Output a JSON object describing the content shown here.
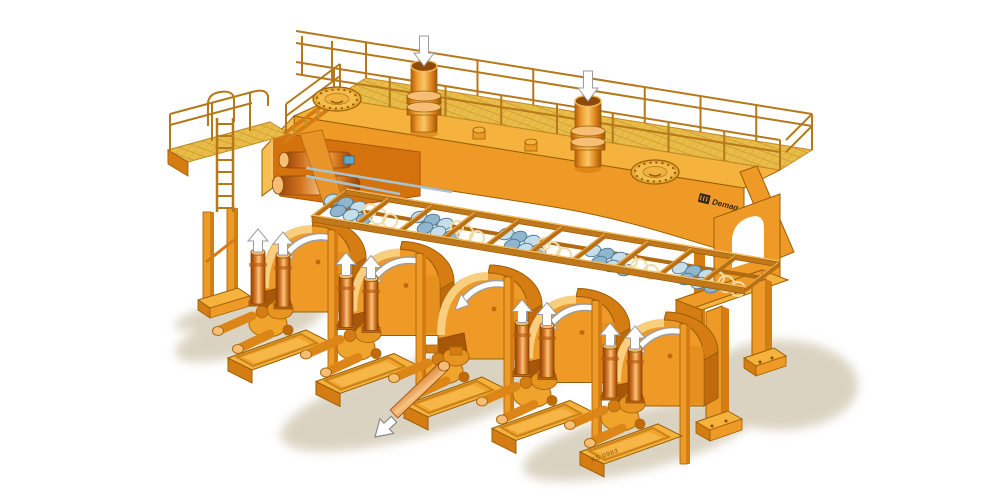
{
  "meta": {
    "background": "#ffffff",
    "description": "Cutaway technical illustration of a five-strand curved-mould billet continuous casting machine"
  },
  "illustration": {
    "type": "isometric cutaway machine illustration",
    "subject": "continuous casting machine",
    "strand_count": 5,
    "pouring_tube_count": 2,
    "manhole_cover_count": 2,
    "flow_arrows": {
      "down_into_moulds": 2,
      "up_on_withdrawal_cylinders": 8,
      "curved_on_strand_guides": 5,
      "billet_exit": 1
    }
  },
  "labels": {
    "brand_text": "Demag",
    "drawing_ref": "KS 0983"
  },
  "palette": {
    "bg": "#ffffff",
    "shadow": "#dbd3c1",
    "orange_top": "#f5b23c",
    "orange_face": "#ef9a26",
    "orange_side": "#d57c12",
    "orange_deep": "#c06a0c",
    "deck_yellow": "#e9bc48",
    "deck_grid": "#c08b27",
    "cavity": "#d4720e",
    "cavity_dark": "#a85608",
    "copper_light": "#f6be74",
    "railing": "#b5791b",
    "roller_light": "#c6deea",
    "roller_mid": "#8fb6cc",
    "roller_dark": "#527f9c",
    "coil": "#f0dca8",
    "arrow_fill": "#ffffff",
    "arrow_edge": "#9c9c9c",
    "outline": "#9a6008",
    "logo_dark": "#33261a",
    "blue_fitting": "#5fa8c8"
  }
}
